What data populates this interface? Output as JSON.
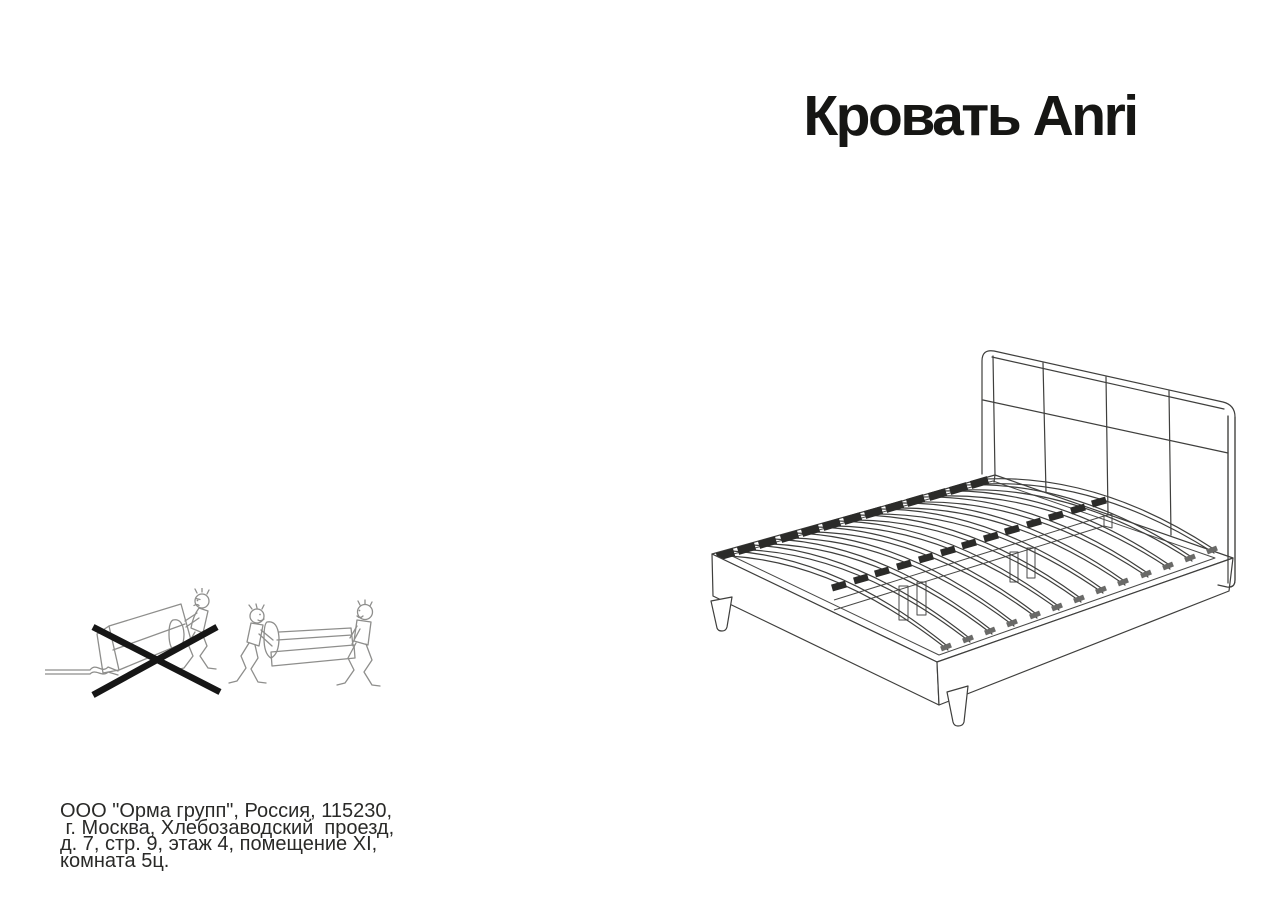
{
  "document": {
    "title": "Кровать Anri",
    "manufacturer": {
      "lines": [
        "ООО \"Орма групп\", Россия, 115230,",
        " г. Москва, Хлебозаводский  проезд,",
        "д. 7, стр. 9, этаж 4, помещение XI,",
        "комната 5ц."
      ]
    },
    "illustrations": {
      "bed_drawing": "bed-technical-drawing",
      "warning": "do-not-drag-single-person",
      "correct": "carry-with-two-people"
    }
  }
}
